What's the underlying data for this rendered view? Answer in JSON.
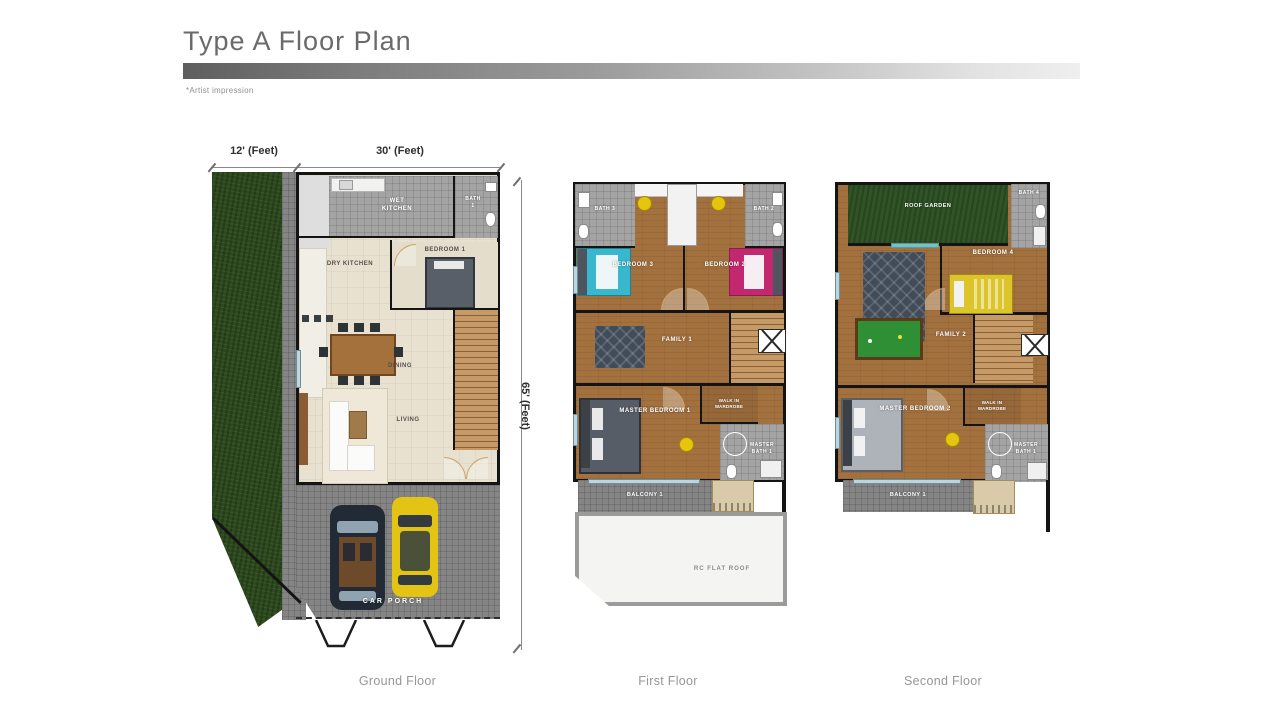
{
  "header": {
    "title": "Type A Floor Plan",
    "note": "*Artist impression"
  },
  "dimensions": {
    "top_left": "12' (Feet)",
    "top_right": "30' (Feet)",
    "side": "65' (Feet)"
  },
  "floors": {
    "ground": {
      "caption": "Ground Floor",
      "rooms": {
        "wet_kitchen": "WET KITCHEN",
        "bath_1": "BATH 1",
        "dry_kitchen": "DRY KITCHEN",
        "bedroom_1": "BEDROOM 1",
        "dining": "DINING",
        "living": "LIVING",
        "car_porch": "CAR PORCH"
      }
    },
    "first": {
      "caption": "First Floor",
      "rooms": {
        "bath_3": "BATH 3",
        "bath_2": "BATH 2",
        "bedroom_3": "BEDROOM 3",
        "bedroom_2": "BEDROOM 2",
        "family_1": "FAMILY 1",
        "master_bedroom_1": "MASTER BEDROOM 1",
        "walk_in_wardrobe": "WALK IN WARDROBE",
        "master_bath_1": "MASTER BATH 1",
        "balcony_1": "BALCONY 1",
        "rc_flat_roof": "RC FLAT ROOF"
      }
    },
    "second": {
      "caption": "Second Floor",
      "rooms": {
        "roof_garden": "ROOF GARDEN",
        "bath_4": "BATH 4",
        "bedroom_4": "BEDROOM 4",
        "family_2": "FAMILY 2",
        "master_bedroom_2": "MASTER BEDROOM 2",
        "walk_in_wardrobe": "WALK IN WARDROBE",
        "master_bath_1": "MASTER BATH 1",
        "balcony_1": "BALCONY 1"
      }
    }
  },
  "colors": {
    "wood_floor": "#a3713e",
    "tile_gray": "#8e8e8e",
    "beige_floor": "#e9e1d0",
    "grass_green": "#2d4a1e",
    "wall_black": "#141414",
    "car_black": "#222a35",
    "car_yellow": "#e3c415",
    "bed_cyan": "#38b7cf",
    "bed_magenta": "#c2276f",
    "bed_yellow": "#dbc52b",
    "pool_table_green": "#2e8f35",
    "title_gray": "#6a6a6a"
  }
}
